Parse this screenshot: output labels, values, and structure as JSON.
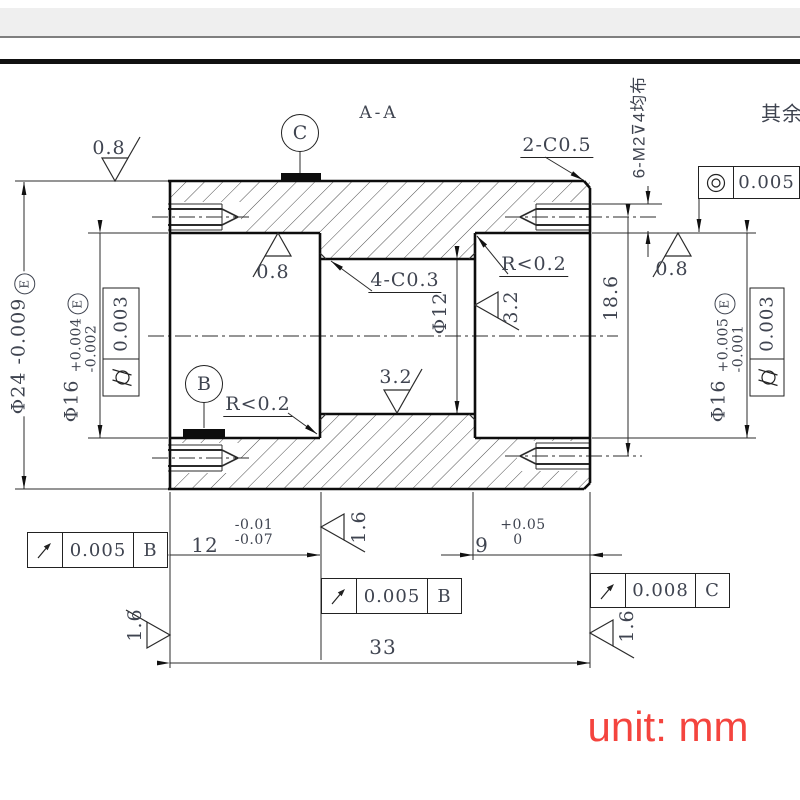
{
  "page": {
    "section_label": "A-A",
    "others_note": "其余",
    "unit_label": "unit: mm",
    "unit_color": "#f4443e",
    "line_color": "#111111",
    "text_color": "#3f4450"
  },
  "annotations": {
    "thread_callout": "6-M2⊽4均布",
    "chamfer_outer": "2-C0.5",
    "chamfer_inner": "4-C0.3",
    "fillet_upper": "R<0.2",
    "fillet_lower": "R<0.2"
  },
  "roughness": {
    "top_face": "0.8",
    "bore_left": "0.8",
    "bore_right": "0.8",
    "bore_center_bottom": "3.2",
    "step_right": "3.2",
    "step_left": "1.6",
    "face_left": "1.6",
    "face_right": "1.6"
  },
  "dimensions": {
    "od": {
      "prefix": "Φ24",
      "tol": "-0.009",
      "envelope": "E"
    },
    "bore_left": {
      "prefix": "Φ16",
      "upper": "+0.004",
      "lower": "-0.002",
      "envelope": "E"
    },
    "bore_right": {
      "prefix": "Φ16",
      "upper": "+0.005",
      "lower": "-0.001",
      "envelope": "E"
    },
    "bore_center": "Φ12",
    "hole_span": "18.6",
    "depth_left": {
      "value": "12",
      "upper": "-0.01",
      "lower": "-0.07"
    },
    "depth_right": {
      "value": "9",
      "upper": "+0.05",
      "lower": "0"
    },
    "length": "33"
  },
  "gdt": {
    "concentricity": {
      "value": "0.005"
    },
    "cylindricity_left": {
      "value": "0.003"
    },
    "cylindricity_right": {
      "value": "0.003"
    },
    "runout_left": {
      "value": "0.005",
      "datum": "B"
    },
    "runout_mid": {
      "value": "0.005",
      "datum": "B"
    },
    "runout_right": {
      "value": "0.008",
      "datum": "C"
    }
  },
  "datums": {
    "b": "B",
    "c": "C"
  }
}
